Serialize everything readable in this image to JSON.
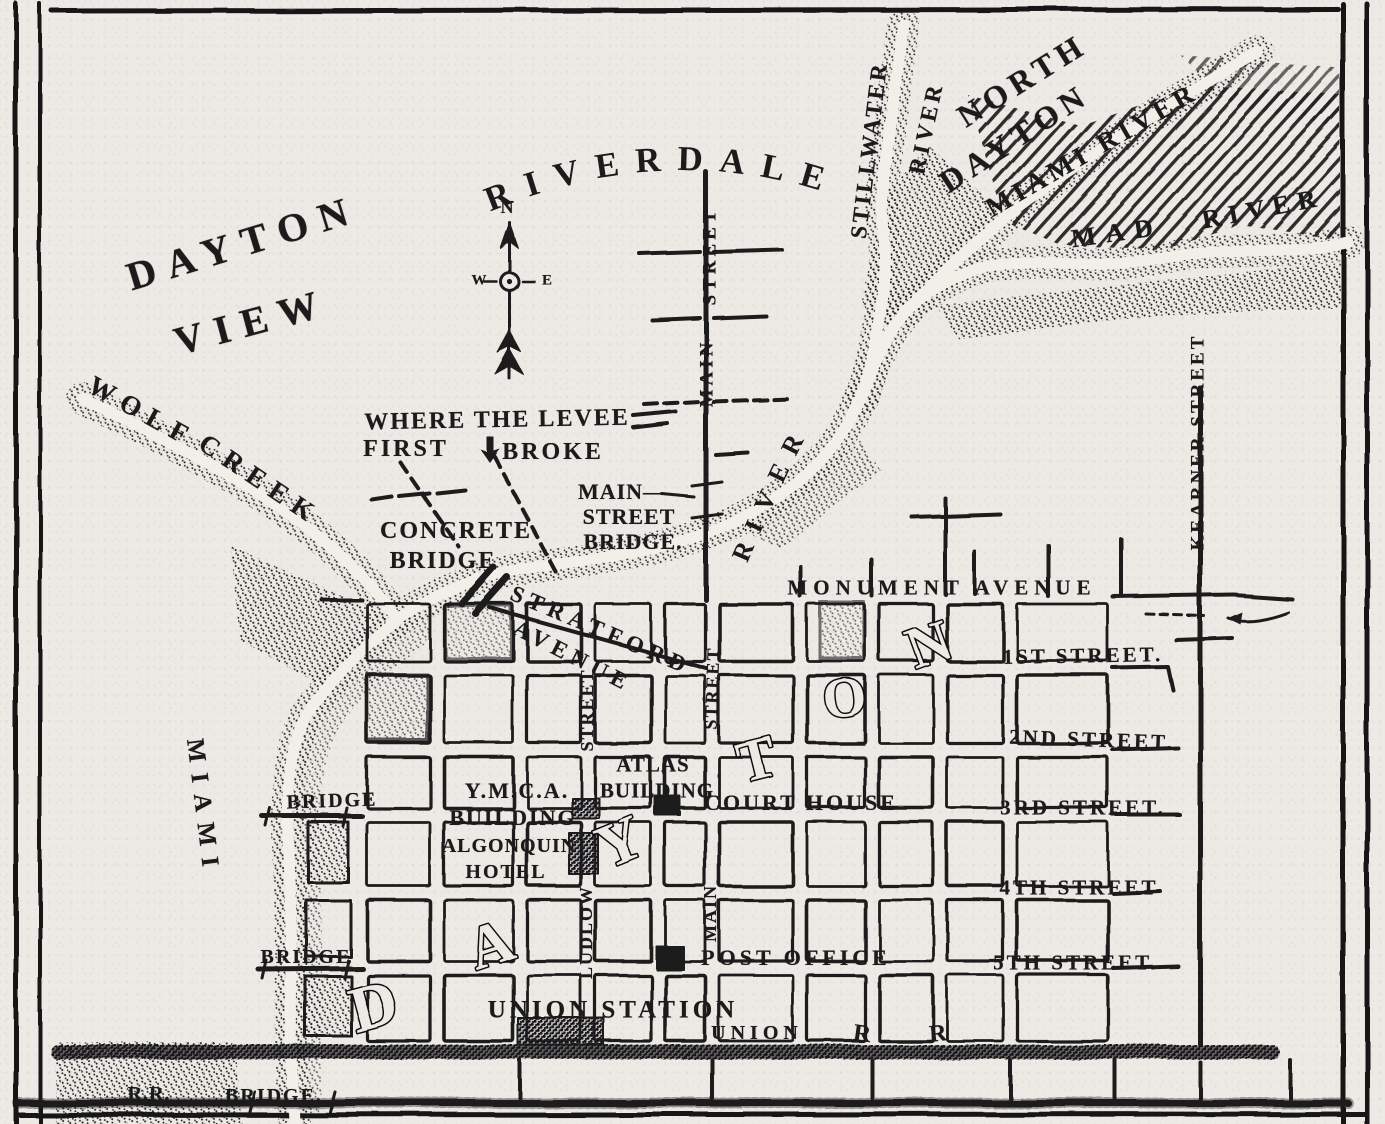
{
  "map": {
    "ink_color": "#1b1b1b",
    "paper_color": "#edeae5",
    "compass": {
      "north": "N",
      "west": "W",
      "east": "E"
    },
    "arc_labels": [
      {
        "id": "riverdale",
        "name": "region-label-riverdale",
        "text": "RIVERDALE",
        "path": "arc-riverdale",
        "size": 35,
        "ls": 16,
        "offset": "6%"
      },
      {
        "id": "river-bend",
        "name": "water-label-river-bend",
        "text": "RIVER",
        "path": "arc-river-bend",
        "size": 26,
        "ls": 13,
        "offset": "10%"
      }
    ],
    "big_letters": [
      {
        "ch": "D",
        "x": 375,
        "y": 1012,
        "r": -15,
        "s": 66
      },
      {
        "ch": "A",
        "x": 492,
        "y": 950,
        "r": -18,
        "s": 60
      },
      {
        "ch": "Y",
        "x": 622,
        "y": 848,
        "r": -22,
        "s": 62
      },
      {
        "ch": "T",
        "x": 758,
        "y": 765,
        "r": -14,
        "s": 58
      },
      {
        "ch": "O",
        "x": 845,
        "y": 703,
        "r": -6,
        "s": 56
      },
      {
        "ch": "N",
        "x": 931,
        "y": 650,
        "r": -20,
        "s": 58
      }
    ],
    "labels": [
      {
        "n": "region-label-dayton-view-1",
        "t": "DAYTON",
        "x": 243,
        "y": 243,
        "r": -17,
        "s": 40,
        "ls": 12,
        "cls": "region"
      },
      {
        "n": "region-label-dayton-view-2",
        "t": "VIEW",
        "x": 252,
        "y": 322,
        "r": -15,
        "s": 40,
        "ls": 12,
        "cls": "region"
      },
      {
        "n": "region-label-north-dayton-1",
        "t": "NORTH",
        "x": 1022,
        "y": 80,
        "r": -32,
        "s": 32,
        "ls": 6,
        "cls": "region"
      },
      {
        "n": "region-label-north-dayton-2",
        "t": "DAYTON",
        "x": 1014,
        "y": 138,
        "r": -33,
        "s": 32,
        "ls": 6,
        "cls": "region"
      },
      {
        "n": "water-label-wolf-creek-1",
        "t": "WOLF",
        "x": 142,
        "y": 412,
        "r": 29,
        "s": 27,
        "ls": 9
      },
      {
        "n": "water-label-wolf-creek-2",
        "t": "CREEK",
        "x": 260,
        "y": 480,
        "r": 34,
        "s": 27,
        "ls": 9
      },
      {
        "n": "water-label-miami-west",
        "t": "MIAMI",
        "x": 203,
        "y": 808,
        "r": 83,
        "s": 25,
        "ls": 11
      },
      {
        "n": "water-label-stillwater-1",
        "t": "STILLWATER",
        "x": 869,
        "y": 150,
        "r": -83,
        "s": 23,
        "ls": 3
      },
      {
        "n": "water-label-stillwater-2",
        "t": "RIVER",
        "x": 926,
        "y": 128,
        "r": -78,
        "s": 23,
        "ls": 4
      },
      {
        "n": "water-label-miami-ne",
        "t": "MIAMI RIVER",
        "x": 1092,
        "y": 150,
        "r": -30,
        "s": 27,
        "ls": 5
      },
      {
        "n": "water-label-mad-1",
        "t": "MAD",
        "x": 1117,
        "y": 233,
        "r": -8,
        "s": 26,
        "ls": 10
      },
      {
        "n": "water-label-mad-2",
        "t": "RIVER",
        "x": 1263,
        "y": 209,
        "r": -11,
        "s": 26,
        "ls": 8
      },
      {
        "n": "street-label-main-riverdale-2",
        "t": "STREET",
        "x": 710,
        "y": 256,
        "r": -90,
        "s": 19,
        "ls": 4
      },
      {
        "n": "street-label-main-riverdale-1",
        "t": "MAIN",
        "x": 707,
        "y": 373,
        "r": -90,
        "s": 19,
        "ls": 4
      },
      {
        "n": "street-label-kearner",
        "t": "KEARNER STREET",
        "x": 1198,
        "y": 442,
        "r": -90,
        "s": 19,
        "ls": 3
      },
      {
        "n": "street-label-stratford-1",
        "t": "STRATFORD",
        "x": 601,
        "y": 630,
        "r": 23,
        "s": 23,
        "ls": 6
      },
      {
        "n": "street-label-stratford-2",
        "t": "AVENUE",
        "x": 573,
        "y": 656,
        "r": 27,
        "s": 23,
        "ls": 6
      },
      {
        "n": "street-label-monument",
        "t": "MONUMENT AVENUE",
        "x": 942,
        "y": 588,
        "r": 0,
        "s": 21,
        "ls": 6
      },
      {
        "n": "street-label-1st",
        "t": "1ST STREET.",
        "x": 1083,
        "y": 656,
        "r": -1,
        "s": 21,
        "ls": 3
      },
      {
        "n": "street-label-2nd",
        "t": "2ND STREET.",
        "x": 1092,
        "y": 740,
        "r": 2,
        "s": 21,
        "ls": 3
      },
      {
        "n": "street-label-3rd",
        "t": "3RD STREET.",
        "x": 1083,
        "y": 808,
        "r": 0,
        "s": 21,
        "ls": 3
      },
      {
        "n": "street-label-4th",
        "t": "4TH STREET",
        "x": 1079,
        "y": 888,
        "r": 0,
        "s": 21,
        "ls": 3
      },
      {
        "n": "street-label-5th",
        "t": "5TH STREET.",
        "x": 1076,
        "y": 963,
        "r": 0,
        "s": 21,
        "ls": 3
      },
      {
        "n": "street-label-ludlow-2",
        "t": "STREET",
        "x": 587,
        "y": 710,
        "r": -90,
        "s": 18,
        "ls": 2
      },
      {
        "n": "street-label-ludlow-1",
        "t": "LUDLOW",
        "x": 586,
        "y": 932,
        "r": -90,
        "s": 18,
        "ls": 2
      },
      {
        "n": "street-label-main-downtown-2",
        "t": "STREET",
        "x": 712,
        "y": 688,
        "r": -88,
        "s": 18,
        "ls": 2
      },
      {
        "n": "street-label-main-downtown-1",
        "t": "MAIN",
        "x": 710,
        "y": 913,
        "r": -90,
        "s": 18,
        "ls": 2
      },
      {
        "n": "annotation-levee-1",
        "t": "WHERE THE LEVEE",
        "x": 497,
        "y": 420,
        "r": -1,
        "s": 24,
        "ls": 2
      },
      {
        "n": "annotation-levee-2",
        "t": "FIRST",
        "x": 406,
        "y": 449,
        "r": 0,
        "s": 24,
        "ls": 3
      },
      {
        "n": "annotation-levee-3",
        "t": "BROKE",
        "x": 553,
        "y": 452,
        "r": 0,
        "s": 24,
        "ls": 3
      },
      {
        "n": "annotation-concrete-bridge-1",
        "t": "CONCRETE",
        "x": 456,
        "y": 531,
        "r": 0,
        "s": 24,
        "ls": 2
      },
      {
        "n": "annotation-concrete-bridge-2",
        "t": "BRIDGE",
        "x": 443,
        "y": 561,
        "r": 0,
        "s": 24,
        "ls": 2
      },
      {
        "n": "annotation-main-st-bridge-1",
        "t": "MAIN—",
        "x": 622,
        "y": 492,
        "r": 0,
        "s": 22,
        "ls": 1
      },
      {
        "n": "annotation-main-st-bridge-2",
        "t": "STREET",
        "x": 629,
        "y": 517,
        "r": 0,
        "s": 22,
        "ls": 1
      },
      {
        "n": "annotation-main-st-bridge-3",
        "t": "BRIDGE.",
        "x": 633,
        "y": 542,
        "r": 0,
        "s": 22,
        "ls": 1
      },
      {
        "n": "place-label-ymca-1",
        "t": "Y.M.C.A.",
        "x": 517,
        "y": 791,
        "r": 0,
        "s": 22,
        "ls": 2
      },
      {
        "n": "place-label-ymca-2",
        "t": "BUILDING",
        "x": 513,
        "y": 818,
        "r": 0,
        "s": 22,
        "ls": 2
      },
      {
        "n": "place-label-atlas-1",
        "t": "ATLAS",
        "x": 653,
        "y": 765,
        "r": 0,
        "s": 21,
        "ls": 1
      },
      {
        "n": "place-label-atlas-2",
        "t": "BUILDING",
        "x": 657,
        "y": 791,
        "r": 0,
        "s": 21,
        "ls": 1
      },
      {
        "n": "place-label-court-house",
        "t": "COURT HOUSE",
        "x": 801,
        "y": 803,
        "r": 0,
        "s": 22,
        "ls": 3
      },
      {
        "n": "place-label-algonquin-1",
        "t": "ALGONQUIN",
        "x": 509,
        "y": 846,
        "r": 0,
        "s": 20,
        "ls": 1
      },
      {
        "n": "place-label-algonquin-2",
        "t": "HOTEL",
        "x": 506,
        "y": 872,
        "r": 0,
        "s": 20,
        "ls": 2
      },
      {
        "n": "place-label-post-office",
        "t": "POST OFFICE",
        "x": 796,
        "y": 958,
        "r": 0,
        "s": 22,
        "ls": 4
      },
      {
        "n": "place-label-union-station",
        "t": "UNION STATION",
        "x": 613,
        "y": 1010,
        "r": 0,
        "s": 25,
        "ls": 4
      },
      {
        "n": "place-label-union-rr",
        "t": "UNION",
        "x": 757,
        "y": 1033,
        "r": 0,
        "s": 20,
        "ls": 5
      },
      {
        "n": "place-label-rr-r1",
        "t": "R",
        "x": 862,
        "y": 1034,
        "r": 8,
        "s": 24,
        "ls": 0
      },
      {
        "n": "place-label-rr-r2",
        "t": "R",
        "x": 938,
        "y": 1034,
        "r": -6,
        "s": 24,
        "ls": 0
      },
      {
        "n": "place-label-bridge-3rd",
        "t": "BRIDGE",
        "x": 332,
        "y": 801,
        "r": -2,
        "s": 20,
        "ls": 2
      },
      {
        "n": "place-label-bridge-5th",
        "t": "BRIDGE",
        "x": 306,
        "y": 957,
        "r": 0,
        "s": 20,
        "ls": 2
      },
      {
        "n": "place-label-rr-bridge-1",
        "t": "R.R.",
        "x": 149,
        "y": 1094,
        "r": 0,
        "s": 20,
        "ls": 1
      },
      {
        "n": "place-label-rr-bridge-2",
        "t": "BRIDGE.",
        "x": 274,
        "y": 1096,
        "r": 0,
        "s": 20,
        "ls": 2
      },
      {
        "n": "compass-label-n",
        "t": "N",
        "x": 507,
        "y": 207,
        "r": 0,
        "s": 18,
        "ls": 0
      },
      {
        "n": "compass-label-w",
        "t": "W",
        "x": 479,
        "y": 281,
        "r": 0,
        "s": 15,
        "ls": 0
      },
      {
        "n": "compass-label-e",
        "t": "E",
        "x": 547,
        "y": 281,
        "r": 0,
        "s": 15,
        "ls": 0
      }
    ]
  }
}
